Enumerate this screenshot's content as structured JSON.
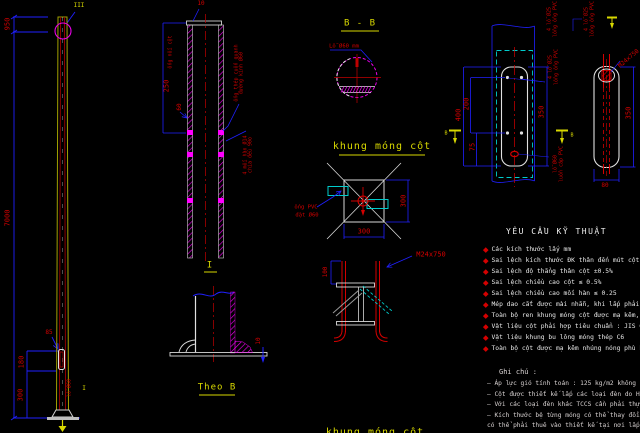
{
  "colors": {
    "background": "#000000",
    "dimension_blue": "#2020ff",
    "annotation_red": "#d40000",
    "title_yellow": "#d8d800",
    "outline_white": "#e0e0e0",
    "hatch_magenta": "#e800e8",
    "anchor_cyan": "#00cccc",
    "pole_olive": "#a0a000"
  },
  "pole_elevation": {
    "detail_callout_top": "III",
    "dim_top_section": "950",
    "dim_total_height": "7000",
    "dim_handhole_offset": "85",
    "dim_handhole_height": "180",
    "dim_base_height": "300",
    "handhole_note": "lỗ Ø60",
    "detail_label_base": "I"
  },
  "section_ii": {
    "dim_cap": "10",
    "note_left": "ống nối cột",
    "dim_sleeve": "250",
    "dim_dia": "60",
    "note_a_line1": "ống thép cuốn quanh",
    "note_a_line2": "đường kính Ø60",
    "note_b_line1": "4 mối hàn Ø14",
    "note_b_line2": "chia đều 90o"
  },
  "section_bb": {
    "title": "B - B",
    "hole_note": "Lỗ Ø60 mm"
  },
  "foundation_plan": {
    "title": "khung móng cột",
    "dim_right": "300",
    "dim_bottom": "300",
    "pvc_note_line1": "ống PVC",
    "pvc_note_line2": "đặt Ø60"
  },
  "anchor_detail": {
    "bolt_label": "M24x750",
    "dim_projection": "100",
    "bottom_title": "khung móng cột"
  },
  "detail_i": {
    "title": "I",
    "dim_plate": "10",
    "view_title": "Theo B"
  },
  "plate_plan": {
    "dim_overall": "400",
    "dim_holes": "200",
    "dim_edge": "75",
    "dim_plate": "350",
    "label_a_line1": "4 lỗ Ø25",
    "label_a_line2": "lồng ống PVC",
    "label_b_line1": "4 lỗ Ø25",
    "label_b_line2": "lồng ống PVC",
    "label_c_line1": "4 lỗ Ø25",
    "label_c_line2": "lồng ống PVC",
    "label_d_line1": "lỗ Ø60",
    "label_d_line2": "luồn cáp PVC",
    "marker_left": "B",
    "marker_right": "B"
  },
  "plate_side": {
    "bolt_label": "M24x750",
    "dim_height": "350",
    "dim_width": "80"
  },
  "tech_requirements": {
    "title": "YÊU CẦU KỸ THUẬT",
    "items": [
      "Các kích thước lấy mm",
      "Sai lệch kích thước ĐK thân đến mút cột ngang",
      "Sai lệch độ thẳng thân cột ±0.5%",
      "Sai lệch chiều cao cột ≤ 0.5%",
      "Sai lệch chiều cao mối hàn ≤ 0.25",
      "Mép dao cắt được mài nhẵn, khi lắp phải bôi",
      "Toàn bộ ren khung móng cột được mạ kẽm, sơn",
      "Vật liệu cột phải hợp tiêu chuẩn : JIS G3101 S",
      "Vật liệu khung bu lông móng thép C6",
      "Toàn bộ cột được mạ kẽm nhúng nóng phù hợp"
    ]
  },
  "notes": {
    "title": "Ghi chú :",
    "items": [
      "– Áp lực gió tính toán : 125 kg/m2 không kể",
      "– Cột được thiết kế lắp các loại đèn do HAPU",
      "– Với các loại đèn khác TCCS cần phải thực hi",
      "– Kích thước bệ từng móng có thể thay đổi th",
      "   có thể phải thuê vào thiết kế tại nơi lắp đặt"
    ]
  }
}
